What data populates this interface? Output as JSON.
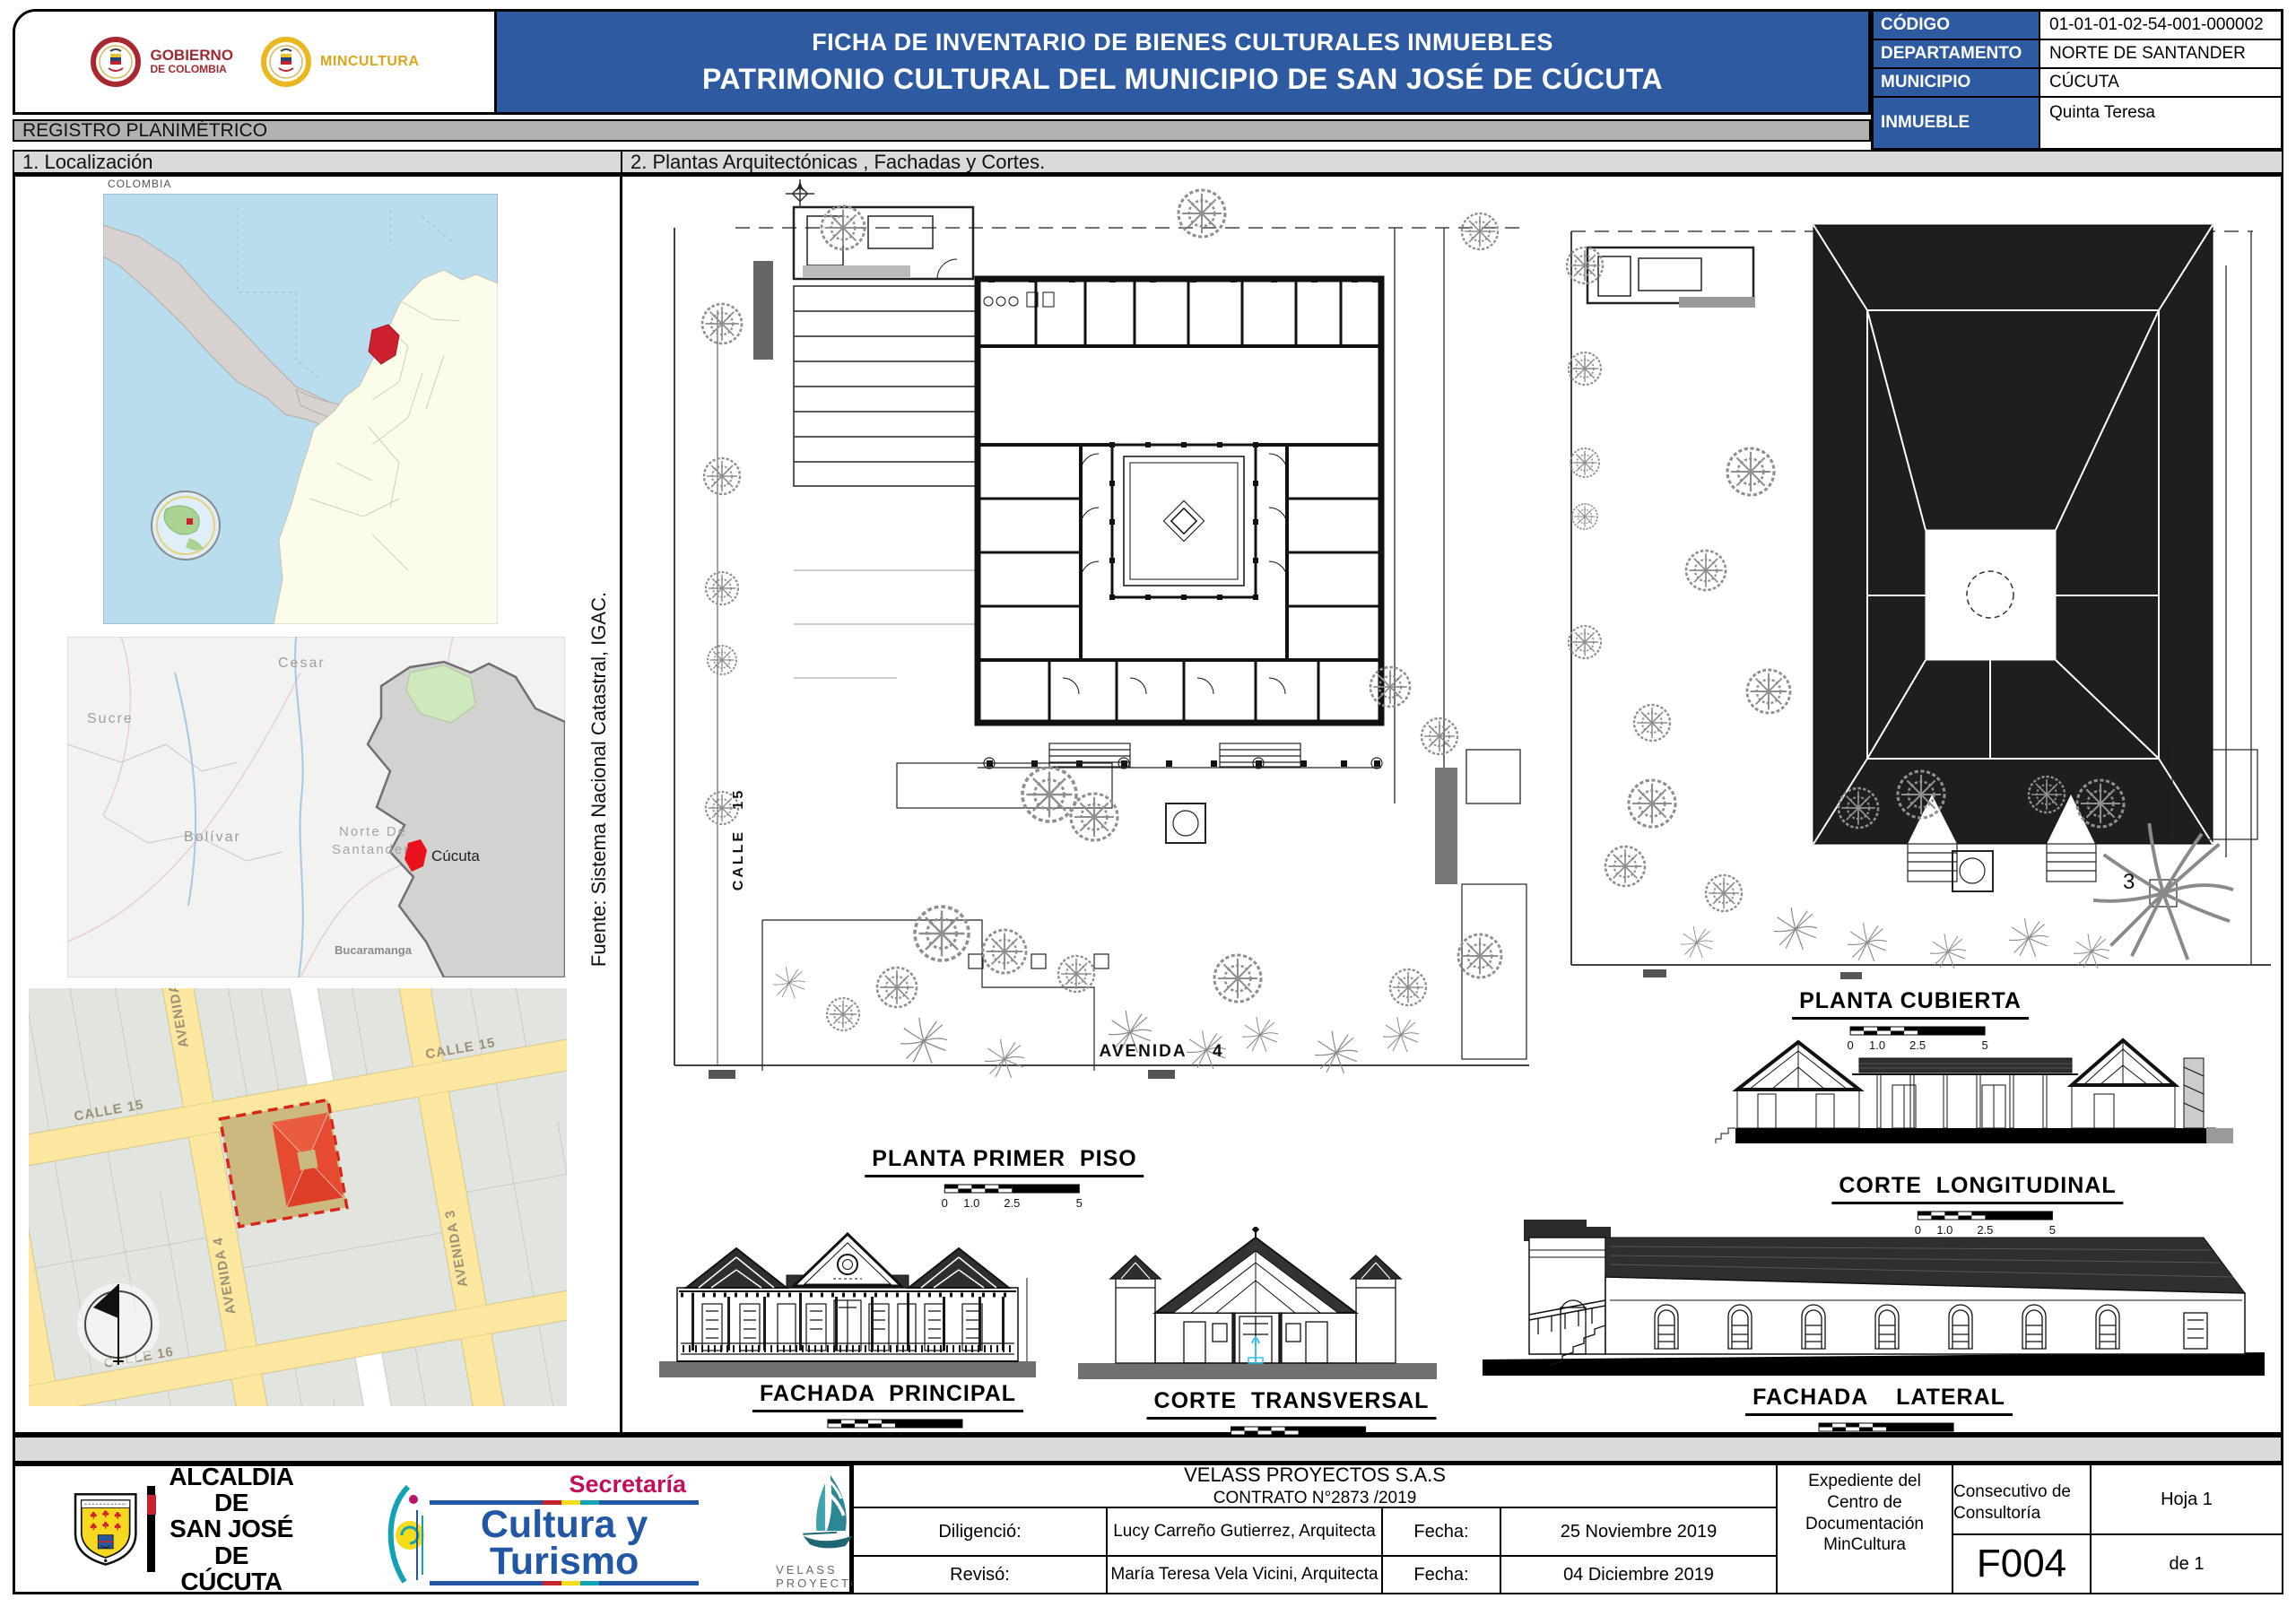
{
  "header": {
    "gobierno": {
      "line1": "GOBIERNO",
      "line2": "DE COLOMBIA"
    },
    "mincultura": "MINCULTURA",
    "title_line1": "FICHA DE INVENTARIO DE BIENES CULTURALES INMUEBLES",
    "title_line2": "PATRIMONIO CULTURAL DEL MUNICIPIO DE SAN JOSÉ DE CÚCUTA",
    "info_rows": [
      {
        "label": "CÓDIGO",
        "value": "01-01-01-02-54-001-000002"
      },
      {
        "label": "DEPARTAMENTO",
        "value": "NORTE DE SANTANDER"
      },
      {
        "label": "MUNICIPIO",
        "value": "CÚCUTA"
      },
      {
        "label": "INMUEBLE",
        "value": "Quinta Teresa"
      }
    ]
  },
  "registro_title": "REGISTRO PLANIMÉTRICO",
  "section1_title": "1. Localización",
  "section2_title": "2. Plantas Arquitectónicas , Fachadas y Cortes.",
  "localizacion": {
    "colombia_caption": "COLOMBIA",
    "department_labels": {
      "cesar": "Cesar",
      "sucre": "Sucre",
      "bolivar": "Bolívar",
      "nds_line1": "Norte De",
      "nds_line2": "Santander",
      "cucuta": "Cúcuta",
      "bucaramanga": "Bucaramanga"
    },
    "street_labels": {
      "avenida_top": "AVENIDA",
      "calle15_a": "CALLE 15",
      "calle15_b": "CALLE 15",
      "avenida4": "AVENIDA 4",
      "avenida3": "AVENIDA 3",
      "calle16": "CALLE 16",
      "avenida5": "A 5"
    },
    "fuente": "Fuente: Sistema Nacional Catastral, IGAC."
  },
  "plans": {
    "scale_ticks": {
      "t0": "0",
      "t1": "1.0",
      "t2": "2.5",
      "t3": "5"
    },
    "primer_piso_title": "PLANTA PRIMER  PISO",
    "cubierta_title": "PLANTA CUBIERTA",
    "corte_longitudinal_title": "CORTE  LONGITUDINAL",
    "fachada_principal_title": "FACHADA  PRINCIPAL",
    "corte_transversal_title": "CORTE  TRANSVERSAL",
    "fachada_lateral_title": "FACHADA    LATERAL",
    "calle15_label": "CALLE   15",
    "avenida4_label": "AVENIDA    4",
    "cubierta_note": "3"
  },
  "footer": {
    "alcaldia_line1": "ALCALDÍA DE",
    "alcaldia_line2": "SAN JOSÉ DE",
    "alcaldia_line3": "CÚCUTA",
    "secretaria_top": "Secretaría",
    "secretaria_line1": "Cultura y",
    "secretaria_line2": "Turismo",
    "velass_caption": "VELASS PROYECTOS",
    "company": "VELASS PROYECTOS S.A.S",
    "contract": "CONTRATO N°2873 /2019",
    "rows": [
      {
        "label": "Diligenció:",
        "name": "Lucy Carreño Gutierrez, Arquitecta",
        "fecha_label": "Fecha:",
        "fecha": "25 Noviembre 2019"
      },
      {
        "label": "Revisó:",
        "name": "María Teresa Vela Vicini, Arquitecta",
        "fecha_label": "Fecha:",
        "fecha": "04 Diciembre 2019"
      }
    ],
    "expediente": "Expediente del Centro de Documentación MinCultura",
    "consecutivo_label_1": "Consecutivo de",
    "consecutivo_label_2": "Consultoría",
    "consecutivo_value": "F004",
    "hoja": "Hoja 1",
    "de": "de 1"
  }
}
